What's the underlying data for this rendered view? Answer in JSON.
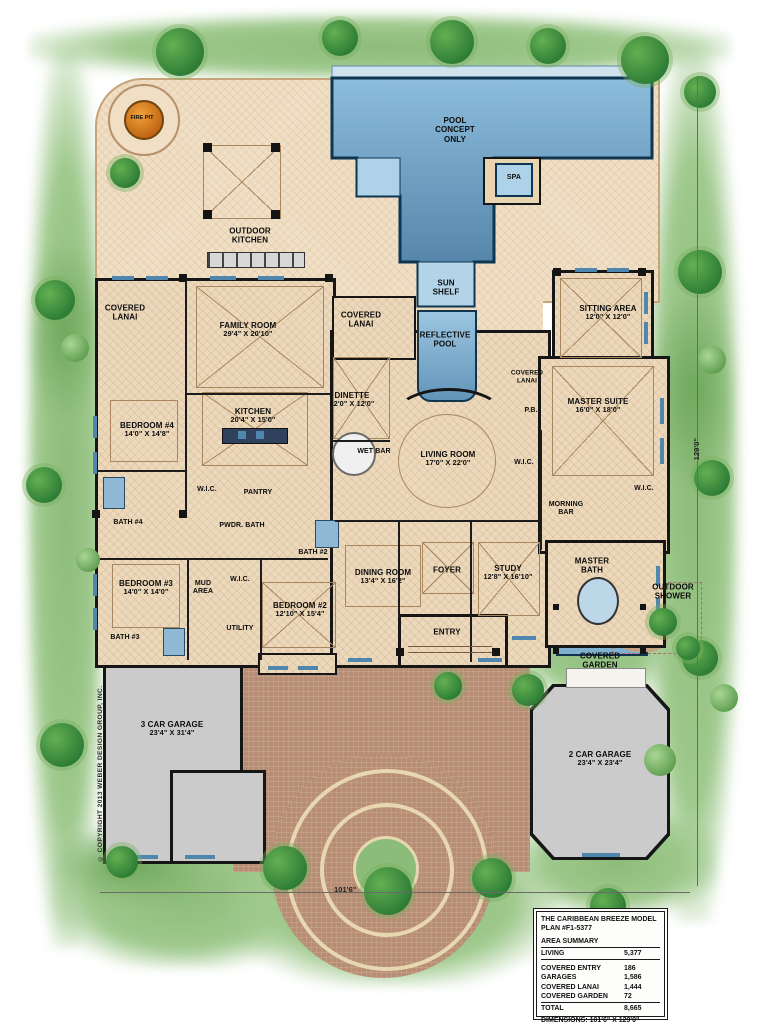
{
  "meta": {
    "copyright": "© COPYRIGHT 2013 WEBER DESIGN GROUP, INC.",
    "dim_right": "129'0\"",
    "dim_bottom": "101'6\""
  },
  "palette": {
    "pool_blue": "#4d7fa9",
    "shelf_blue": "#aed2e7",
    "floor_tan": "#ecd8ba",
    "garage_gray": "#cbcbcb",
    "driveway_brick": "#b78e74",
    "landscape_green": "#9fc98d",
    "fire_pit_orange": "#e08a20",
    "wall_black": "#161616"
  },
  "title_block": {
    "title": "THE CARIBBEAN BREEZE MODEL",
    "plan": "PLAN #F1-5377",
    "area_summary_heading": "AREA SUMMARY",
    "living": {
      "label": "LIVING",
      "value": "5,377"
    },
    "rows": [
      {
        "label": "COVERED ENTRY",
        "value": "186"
      },
      {
        "label": "GARAGES",
        "value": "1,586"
      },
      {
        "label": "COVERED LANAI",
        "value": "1,444"
      },
      {
        "label": "COVERED GARDEN",
        "value": "72"
      }
    ],
    "total": {
      "label": "TOTAL",
      "value": "8,665"
    },
    "dimensions": "DIMENSIONS: 101'6\" X 129'0\""
  },
  "rooms": {
    "pool": {
      "name": "POOL CONCEPT ONLY"
    },
    "spa": {
      "name": "SPA"
    },
    "sun_shelf": {
      "name": "SUN SHELF"
    },
    "reflective_pool": {
      "name": "REFLECTIVE POOL"
    },
    "fire_pit": {
      "name": "FIRE PIT"
    },
    "outdoor_kitchen": {
      "name": "OUTDOOR KITCHEN"
    },
    "covered_lanai_left": {
      "name": "COVERED LANAI"
    },
    "covered_lanai_right": {
      "name": "COVERED LANAI"
    },
    "covered_lanai_small": {
      "name": "COVERED LANAI"
    },
    "family_room": {
      "name": "FAMILY ROOM",
      "dims": "29'4\" X 20'10\""
    },
    "sitting_area": {
      "name": "SITTING AREA",
      "dims": "12'0\" X 12'0\""
    },
    "dinette": {
      "name": "DINETTE",
      "dims": "12'0\" X 12'0\""
    },
    "kitchen": {
      "name": "KITCHEN",
      "dims": "20'4\" X 15'0\""
    },
    "bedroom4": {
      "name": "BEDROOM #4",
      "dims": "14'0\" X 14'8\""
    },
    "wet_bar": {
      "name": "WET BAR"
    },
    "living_room": {
      "name": "LIVING ROOM",
      "dims": "17'0\" X 22'0\""
    },
    "pb": {
      "name": "P.B."
    },
    "master_suite": {
      "name": "MASTER SUITE",
      "dims": "16'0\" X 18'0\""
    },
    "wic_master_left": {
      "name": "W.I.C."
    },
    "wic_master_right": {
      "name": "W.I.C."
    },
    "morning_bar": {
      "name": "MORNING BAR"
    },
    "bath4": {
      "name": "BATH #4"
    },
    "wic_bed4": {
      "name": "W.I.C."
    },
    "pantry": {
      "name": "PANTRY"
    },
    "pwdr_bath": {
      "name": "PWDR. BATH"
    },
    "bath2": {
      "name": "BATH #2"
    },
    "bedroom3": {
      "name": "BEDROOM #3",
      "dims": "14'0\" X 14'0\""
    },
    "mud_area": {
      "name": "MUD AREA"
    },
    "wic_bed2": {
      "name": "W.I.C."
    },
    "bedroom2": {
      "name": "BEDROOM #2",
      "dims": "12'10\" X 15'4\""
    },
    "utility": {
      "name": "UTILITY"
    },
    "bath3": {
      "name": "BATH #3"
    },
    "dining_room": {
      "name": "DINING ROOM",
      "dims": "13'4\" X 16'2\""
    },
    "foyer": {
      "name": "FOYER"
    },
    "study": {
      "name": "STUDY",
      "dims": "12'8\" X 16'10\""
    },
    "master_bath": {
      "name": "MASTER BATH"
    },
    "entry": {
      "name": "ENTRY"
    },
    "outdoor_shower": {
      "name": "OUTDOOR SHOWER"
    },
    "covered_garden": {
      "name": "COVERED GARDEN"
    },
    "garage3": {
      "name": "3 CAR GARAGE",
      "dims": "23'4\" X 31'4\""
    },
    "garage2": {
      "name": "2 CAR GARAGE",
      "dims": "23'4\" X 23'4\""
    }
  }
}
